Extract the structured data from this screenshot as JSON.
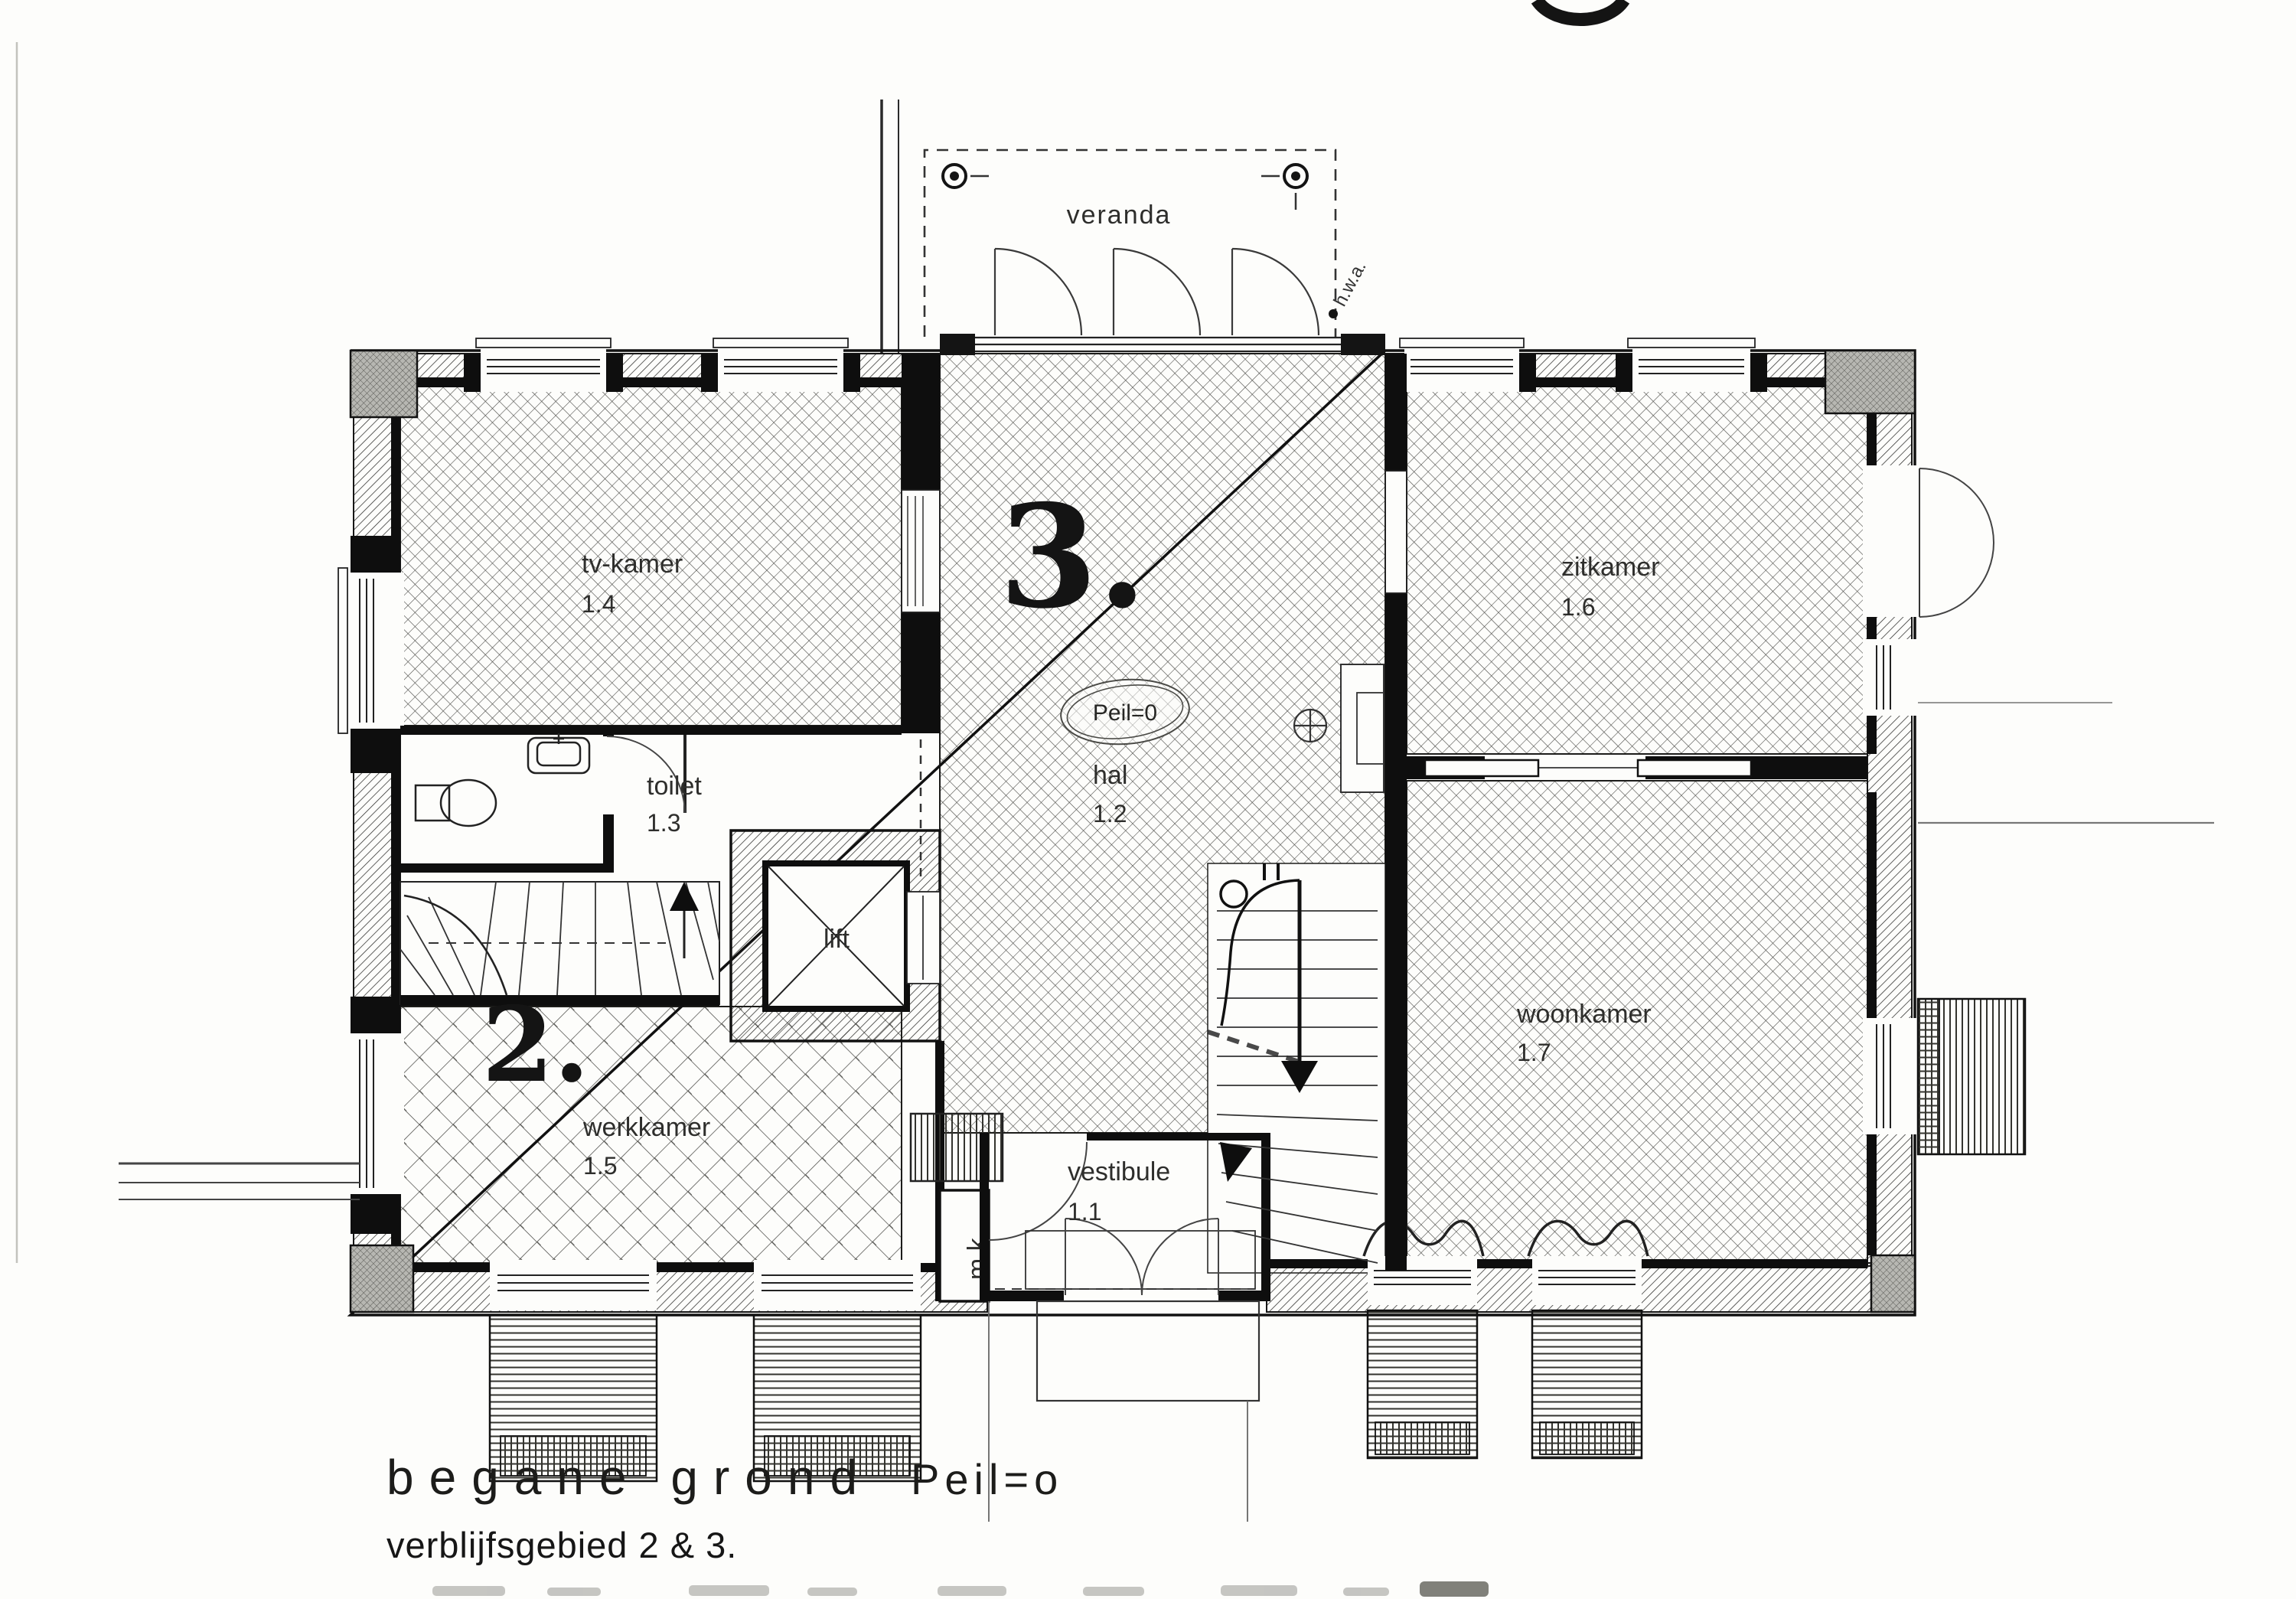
{
  "page": {
    "caption": {
      "line1_left": "begane grond",
      "line1_right": "Peil=o",
      "line2": "verblijfsgebied 2 & 3."
    },
    "rooms": [
      {
        "name": "veranda",
        "number": ""
      },
      {
        "name": "tv-kamer",
        "number": "1.4"
      },
      {
        "name": "zitkamer",
        "number": "1.6"
      },
      {
        "name": "toilet",
        "number": "1.3"
      },
      {
        "name": "hal",
        "number": "1.2"
      },
      {
        "name": "lift",
        "number": ""
      },
      {
        "name": "werkkamer",
        "number": "1.5"
      },
      {
        "name": "woonkamer",
        "number": "1.7"
      },
      {
        "name": "vestibule",
        "number": "1.1"
      },
      {
        "name": "m.k.",
        "number": ""
      }
    ],
    "zone_labels": {
      "zone2": "2.",
      "zone3": "3."
    },
    "annotations": {
      "peil_badge": "Peil=0",
      "hwa": "h.w.a."
    },
    "colors": {
      "ink": "#1a1a1a",
      "paper": "#fdfdfb",
      "hatch": "#3d3d3d"
    }
  }
}
